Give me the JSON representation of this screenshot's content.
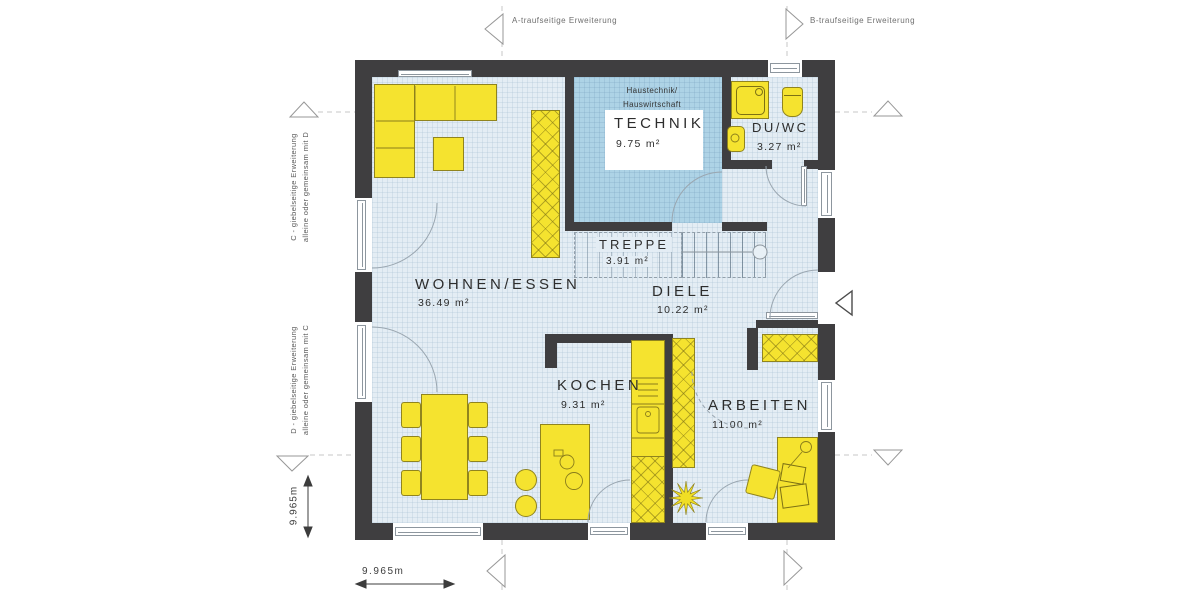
{
  "plan": {
    "rooms": [
      {
        "name": "WOHNEN/ESSEN",
        "area": "36.49 m²"
      },
      {
        "name": "KOCHEN",
        "area": "9.31 m²"
      },
      {
        "name": "TREPPE",
        "area": "3.91 m²"
      },
      {
        "name": "DIELE",
        "area": "10.22 m²"
      },
      {
        "name": "ARBEITEN",
        "area": "11.00 m²"
      },
      {
        "name": "TECHNIK",
        "area": "9.75 m²",
        "note1": "Haustechnik/",
        "note2": "Hauswirtschaft"
      },
      {
        "name": "DU/WC",
        "area": "3.27 m²"
      }
    ]
  },
  "annotations": {
    "axis_a_label": "A-traufseitige Erweiterung",
    "axis_b_label": "B-traufseitige Erweiterung",
    "axis_c_line1": "C - giebelseitige Erweiterung",
    "axis_c_line2": "alleine oder gemeinsam mit D",
    "axis_d_line1": "D - giebelseitige Erweiterung",
    "axis_d_line2": "alleine oder gemeinsam mit C",
    "dimension_left": "9.965m",
    "dimension_bottom": "9.965m"
  },
  "colors": {
    "wall": "#3f3e40",
    "floor": "#e4edf4",
    "technik_floor": "#aed3e6",
    "furniture": "#f5e32f",
    "furniture_border": "#90841e"
  }
}
